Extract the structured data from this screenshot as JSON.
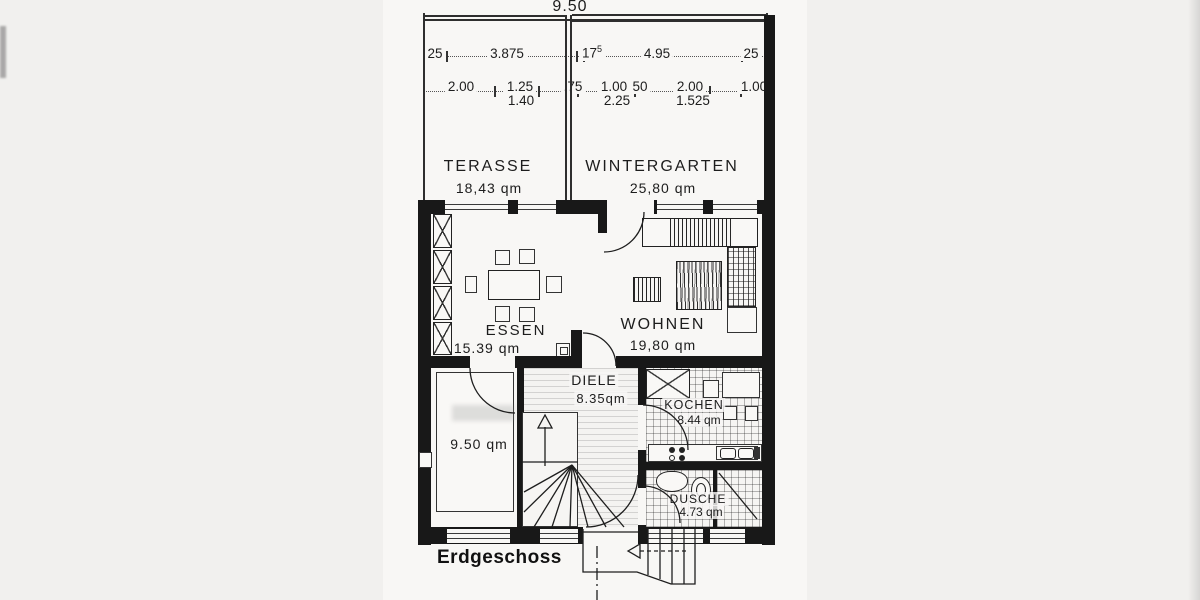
{
  "colors": {
    "ink": "#1a1a1a",
    "paper": "#f8f7f5"
  },
  "floor_label": "Erdgeschoss",
  "dimensions": {
    "total": "9.50",
    "terrace_left_offset": "25",
    "terrace_width": "3.875",
    "wg_offset_base": "17",
    "wg_offset_sup": "5",
    "wg_width": "4.95",
    "wg_right_offset": "25",
    "d200a": "2.00",
    "d125": "1.25",
    "d140": "1.40",
    "d75": ".75",
    "d100a": "1.00",
    "d225": "2.25",
    "d50": "50",
    "d200b": "2.00",
    "d1525": "1.525",
    "d100b": "1.00"
  },
  "rooms": {
    "terasse": {
      "name": "TERASSE",
      "area": "18,43 qm"
    },
    "wintergarten": {
      "name": "WINTERGARTEN",
      "area": "25,80 qm"
    },
    "essen": {
      "name": "ESSEN",
      "area": "15.39 qm"
    },
    "wohnen": {
      "name": "WOHNEN",
      "area": "19,80 qm"
    },
    "diele": {
      "name": "DIELE",
      "area": "8.35qm"
    },
    "kochen": {
      "name": "KOCHEN",
      "area": "8.44 qm"
    },
    "dusche": {
      "name": "DUSCHE",
      "area": "4.73 qm"
    },
    "zimmer": {
      "area": "9.50 qm"
    }
  }
}
